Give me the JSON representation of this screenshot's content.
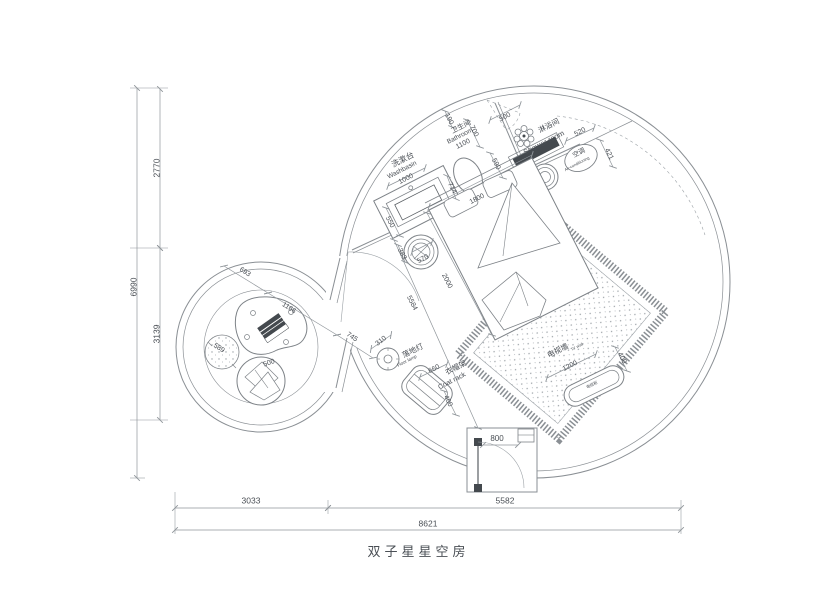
{
  "meta": {
    "title_text": "双子星星空房",
    "drawing_type": "floor plan"
  },
  "colors": {
    "wall": "#8a8f94",
    "furniture": "#7d8287",
    "dim": "#8f959a",
    "text": "#4a4f55",
    "dark": "#44494e",
    "background": "#ffffff"
  },
  "overall_dimensions": {
    "total_width": "8621",
    "left_width": "3033",
    "right_width": "5582",
    "total_height": "6990",
    "upper_height": "2770",
    "lower_height": "3139"
  },
  "rooms": [
    {
      "name_zh": "卫生间",
      "name_en": "Bathroom",
      "width": "1100"
    },
    {
      "name_zh": "淋浴间",
      "name_en": "Shower room"
    },
    {
      "name_zh": "洗漱台",
      "name_en": "Washbasin",
      "width": "1000"
    }
  ],
  "fixtures": [
    {
      "name_zh": "空调",
      "name_en": "Air-conditioning"
    },
    {
      "name_zh": "落地灯",
      "name_en": "Floor lamp",
      "dim": "310"
    },
    {
      "name_zh": "衣帽架",
      "name_en": "Coat rack",
      "dims": "660 x 400"
    },
    {
      "name_zh": "电视墙",
      "name_en": "TV wall",
      "dims": "1200 x 400"
    },
    {
      "name_zh": "电视柜",
      "name_en": ""
    },
    {
      "name": "bed",
      "dims": "1800 x 2000"
    },
    {
      "name": "entry door",
      "dim": "800"
    }
  ],
  "labels": [
    {
      "id": "dim-2770",
      "text": "2770",
      "x": 157,
      "y": 168,
      "rot": -90,
      "size": 8.5
    },
    {
      "id": "dim-6990",
      "text": "6990",
      "x": 134,
      "y": 287,
      "rot": -90,
      "size": 8.5
    },
    {
      "id": "dim-3139",
      "text": "3139",
      "x": 157,
      "y": 334,
      "rot": -90,
      "size": 8.5
    },
    {
      "id": "dim-3033",
      "text": "3033",
      "x": 251,
      "y": 501,
      "rot": 0,
      "size": 8.5
    },
    {
      "id": "dim-5582",
      "text": "5582",
      "x": 505,
      "y": 501,
      "rot": 0,
      "size": 8.5
    },
    {
      "id": "dim-8621",
      "text": "8621",
      "x": 428,
      "y": 524,
      "rot": 0,
      "size": 8.5
    },
    {
      "id": "washbasin-zh",
      "text": "洗漱台",
      "x": 403,
      "y": 160,
      "rot": -27,
      "size": 8
    },
    {
      "id": "washbasin-en",
      "text": "Washbasin",
      "x": 402,
      "y": 170,
      "rot": -27,
      "size": 6.5
    },
    {
      "id": "dim-1000",
      "text": "1000",
      "x": 406,
      "y": 179,
      "rot": -27,
      "size": 7
    },
    {
      "id": "dim-550",
      "text": "550",
      "x": 390,
      "y": 222,
      "rot": 63,
      "size": 7
    },
    {
      "id": "bathroom-zh",
      "text": "卫生间",
      "x": 461,
      "y": 127,
      "rot": -27,
      "size": 7
    },
    {
      "id": "bathroom-en",
      "text": "Bathroom",
      "x": 460,
      "y": 136,
      "rot": -27,
      "size": 6.5
    },
    {
      "id": "dim-1100",
      "text": "1100",
      "x": 463,
      "y": 144,
      "rot": -27,
      "size": 7
    },
    {
      "id": "dim-190",
      "text": "190",
      "x": 449,
      "y": 119,
      "rot": 63,
      "size": 7
    },
    {
      "id": "dim-700",
      "text": "700",
      "x": 474,
      "y": 131,
      "rot": 63,
      "size": 7
    },
    {
      "id": "dim-500-top",
      "text": "500",
      "x": 505,
      "y": 117,
      "rot": -27,
      "size": 7
    },
    {
      "id": "dim-590",
      "text": "590",
      "x": 496,
      "y": 164,
      "rot": 63,
      "size": 7
    },
    {
      "id": "dim-714",
      "text": "714",
      "x": 452,
      "y": 188,
      "rot": 63,
      "size": 7
    },
    {
      "id": "dim-1800",
      "text": "1800",
      "x": 477,
      "y": 199,
      "rot": -27,
      "size": 7
    },
    {
      "id": "shower-zh",
      "text": "淋浴间",
      "x": 549,
      "y": 126,
      "rot": -27,
      "size": 7.5
    },
    {
      "id": "shower-en",
      "text": "Shower room",
      "x": 544,
      "y": 143,
      "rot": -27,
      "size": 7.5
    },
    {
      "id": "ac-zh",
      "text": "空调",
      "x": 579,
      "y": 153,
      "rot": -27,
      "size": 6.5
    },
    {
      "id": "ac-en",
      "text": "Air-conditioning",
      "x": 577,
      "y": 164,
      "rot": -27,
      "size": 4
    },
    {
      "id": "dim-520",
      "text": "520",
      "x": 580,
      "y": 132,
      "rot": -27,
      "size": 7
    },
    {
      "id": "dim-421",
      "text": "421",
      "x": 609,
      "y": 154,
      "rot": 63,
      "size": 7
    },
    {
      "id": "dim-383",
      "text": "383",
      "x": 402,
      "y": 254,
      "rot": 63,
      "size": 7
    },
    {
      "id": "dim-570",
      "text": "570",
      "x": 423,
      "y": 259,
      "rot": -27,
      "size": 7
    },
    {
      "id": "dim-2000",
      "text": "2000",
      "x": 447,
      "y": 281,
      "rot": 63,
      "size": 7
    },
    {
      "id": "dim-5584",
      "text": "5584",
      "x": 412,
      "y": 303,
      "rot": 63,
      "size": 7
    },
    {
      "id": "dim-310",
      "text": "310",
      "x": 381,
      "y": 341,
      "rot": -38,
      "size": 7
    },
    {
      "id": "floorlamp-zh",
      "text": "落地灯",
      "x": 413,
      "y": 351,
      "rot": -27,
      "size": 7.5
    },
    {
      "id": "floorlamp-en",
      "text": "Floor lamp",
      "x": 407,
      "y": 361,
      "rot": -27,
      "size": 4.5
    },
    {
      "id": "dim-660",
      "text": "660",
      "x": 434,
      "y": 369,
      "rot": -27,
      "size": 7
    },
    {
      "id": "coatrack-zh",
      "text": "衣帽架",
      "x": 456,
      "y": 368,
      "rot": -27,
      "size": 7.5
    },
    {
      "id": "coatrack-en",
      "text": "Coat rack",
      "x": 452,
      "y": 381,
      "rot": -27,
      "size": 7
    },
    {
      "id": "dim-400-coat",
      "text": "400",
      "x": 448,
      "y": 401,
      "rot": 63,
      "size": 7
    },
    {
      "id": "tvwall-zh",
      "text": "电视墙",
      "x": 558,
      "y": 351,
      "rot": -27,
      "size": 7.5
    },
    {
      "id": "tvwall-en",
      "text": "TV wall",
      "x": 577,
      "y": 347,
      "rot": -27,
      "size": 4
    },
    {
      "id": "dim-1200",
      "text": "1200",
      "x": 570,
      "y": 366,
      "rot": -27,
      "size": 7
    },
    {
      "id": "dim-400-tv",
      "text": "400",
      "x": 622,
      "y": 358,
      "rot": 63,
      "size": 7
    },
    {
      "id": "tvcabinet",
      "text": "电视柜",
      "x": 592,
      "y": 385,
      "rot": -26,
      "size": 4
    },
    {
      "id": "dim-800",
      "text": "800",
      "x": 497,
      "y": 439,
      "rot": 0,
      "size": 8
    },
    {
      "id": "dim-693",
      "text": "693",
      "x": 245,
      "y": 272,
      "rot": 33,
      "size": 7
    },
    {
      "id": "dim-1166",
      "text": "1166",
      "x": 289,
      "y": 308,
      "rot": 33,
      "size": 7
    },
    {
      "id": "dim-745",
      "text": "745",
      "x": 352,
      "y": 337,
      "rot": 33,
      "size": 7
    },
    {
      "id": "dim-589",
      "text": "589",
      "x": 219,
      "y": 348,
      "rot": 33,
      "size": 7
    },
    {
      "id": "dim-500-basket",
      "text": "500",
      "x": 269,
      "y": 363,
      "rot": -20,
      "size": 7
    }
  ]
}
